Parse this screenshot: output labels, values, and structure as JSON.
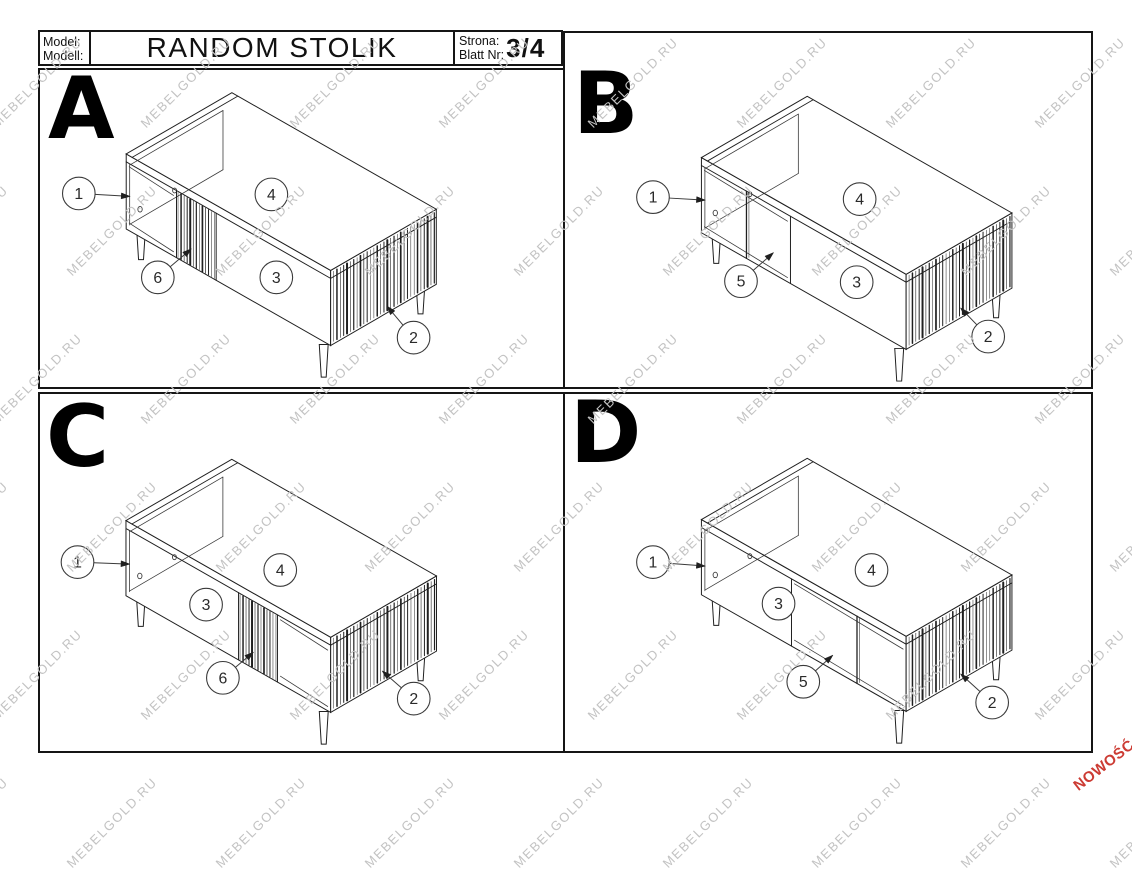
{
  "header": {
    "model_label_line1": "Model:",
    "model_label_line2": "Modell:",
    "title": "RANDOM STOLIK",
    "page_label_line1": "Strona:",
    "page_label_line2": "Blatt Nr:",
    "page_value": "3/4"
  },
  "watermark": {
    "text": "MEBELGOLD.RU",
    "color": "#c3c3c3"
  },
  "badge": {
    "text": "NOWOŚĆ",
    "color": "#cc3b33"
  },
  "drawing": {
    "line_color": "#1f1f1f",
    "hint_color": "#3a3a3a",
    "callout_stroke": "#3a3a3a",
    "callout_text_color": "#2a2a2a"
  },
  "panels": [
    {
      "letter": "A",
      "variant": "slat",
      "table_origin": [
        86,
        85
      ],
      "inner_leg": [
        100,
        97
      ],
      "sections": {
        "open": [
          [
            0,
            0.246
          ]
        ],
        "slats": [
          0.246,
          0.44
        ]
      },
      "callouts": [
        {
          "label": "1",
          "x": 38,
          "y": 125,
          "arrow": {
            "x": 90,
            "y": 128
          }
        },
        {
          "label": "4",
          "x": 233,
          "y": 126
        },
        {
          "label": "6",
          "x": 118,
          "y": 210,
          "arrow": {
            "x": 152,
            "y": 181
          }
        },
        {
          "label": "3",
          "x": 238,
          "y": 210
        },
        {
          "label": "2",
          "x": 377,
          "y": 271,
          "arrow": {
            "x": 350,
            "y": 239
          }
        }
      ]
    },
    {
      "letter": "B",
      "variant": "divider",
      "table_origin": [
        137,
        126
      ],
      "inner_leg": [
        100,
        97
      ],
      "sections": {
        "open": [
          [
            0,
            0.435
          ]
        ],
        "divider": 0.22
      },
      "callouts": [
        {
          "label": "1",
          "x": 88,
          "y": 166,
          "arrow": {
            "x": 141,
            "y": 169
          }
        },
        {
          "label": "4",
          "x": 297,
          "y": 168
        },
        {
          "label": "5",
          "x": 177,
          "y": 251,
          "arrow": {
            "x": 210,
            "y": 222
          }
        },
        {
          "label": "3",
          "x": 294,
          "y": 252
        },
        {
          "label": "2",
          "x": 427,
          "y": 307,
          "arrow": {
            "x": 399,
            "y": 278
          }
        }
      ]
    },
    {
      "letter": "C",
      "variant": "slat",
      "table_origin": [
        86,
        128
      ],
      "inner_leg": [
        160,
        110
      ],
      "sections": {
        "open": [
          [
            0.74,
            1
          ]
        ],
        "slats": [
          0.55,
          0.74
        ]
      },
      "callouts": [
        {
          "label": "1",
          "x": 37,
          "y": 170,
          "arrow": {
            "x": 90,
            "y": 172
          }
        },
        {
          "label": "4",
          "x": 242,
          "y": 178
        },
        {
          "label": "3",
          "x": 167,
          "y": 213
        },
        {
          "label": "6",
          "x": 184,
          "y": 287,
          "arrow": {
            "x": 215,
            "y": 261
          }
        },
        {
          "label": "2",
          "x": 377,
          "y": 308,
          "arrow": {
            "x": 345,
            "y": 280
          }
        }
      ]
    },
    {
      "letter": "D",
      "variant": "divider",
      "table_origin": [
        137,
        127
      ],
      "inner_leg": [
        165,
        110
      ],
      "sections": {
        "open": [
          [
            0.44,
            1
          ]
        ],
        "divider": 0.76
      },
      "callouts": [
        {
          "label": "1",
          "x": 88,
          "y": 170,
          "arrow": {
            "x": 141,
            "y": 174
          }
        },
        {
          "label": "4",
          "x": 309,
          "y": 178
        },
        {
          "label": "3",
          "x": 215,
          "y": 212
        },
        {
          "label": "5",
          "x": 240,
          "y": 291,
          "arrow": {
            "x": 270,
            "y": 264
          }
        },
        {
          "label": "2",
          "x": 431,
          "y": 312,
          "arrow": {
            "x": 399,
            "y": 283
          }
        }
      ]
    }
  ]
}
